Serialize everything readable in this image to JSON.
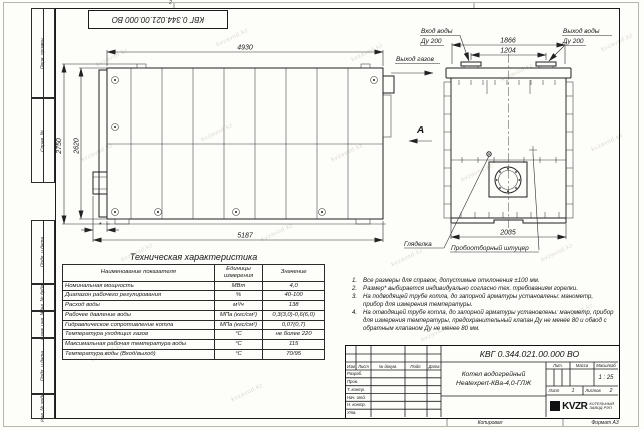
{
  "sheet": {
    "watermark": "kvzavod.kz",
    "top_mark": "2",
    "copied_label": "Копировал",
    "format_label": "Формат А3",
    "top_stamp": "КВГ 0.344.021.00.000 ВО"
  },
  "margin": {
    "labels": [
      "Перв. примен.",
      "Справ. №",
      "Подп. и дата",
      "Инв. № дубл.",
      "Взам. инв. №",
      "Подп. и дата",
      "Инв. № подл."
    ]
  },
  "drawing": {
    "main_view": {
      "dim_width_top": "4930",
      "dim_width_bottom": "5187",
      "dim_height_outer": "2750",
      "dim_height_inner": "2620",
      "dim_burner": "*"
    },
    "end_view": {
      "dim_nozzle_outer": "1866",
      "dim_nozzle_inner": "1204",
      "dim_width": "2035",
      "label_water_in": "Вход воды",
      "label_water_in_dn": "Ду 200",
      "label_water_out": "Выход воды",
      "label_water_out_dn": "Ду 200",
      "label_gas_out": "Выход газов",
      "view_arrow": "А",
      "label_sight_glass": "Гляделка",
      "label_sampling": "Пробоотборный штуцер"
    }
  },
  "spec_table": {
    "title": "Техническая характеристика",
    "headers": [
      "Наименование показателя",
      "Единицы измерения",
      "Значение"
    ],
    "rows": [
      [
        "Номинальная мощность",
        "МВт",
        "4,0"
      ],
      [
        "Диапазон рабочего регулирования",
        "%",
        "40-100"
      ],
      [
        "Расход воды",
        "м³/ч",
        "138"
      ],
      [
        "Рабочее давление воды",
        "МПа (кгс/см²)",
        "0,3(3,0)-0,6(6,0)"
      ],
      [
        "Гидравлическое сопротивление котла",
        "МПа (кгс/см²)",
        "0,07(0,7)"
      ],
      [
        "Температура уходящих газов",
        "°С",
        "не более 220"
      ],
      [
        "Максимальная рабочая температура воды",
        "°С",
        "115"
      ],
      [
        "Температура воды (Вход/выход)",
        "°С",
        "70/95"
      ]
    ]
  },
  "notes": {
    "items": [
      {
        "n": "1.",
        "text": "Все размеры для справок, допустимые отклонения ±100 мм."
      },
      {
        "n": "2.",
        "text": "Размер* выбирается индивидуально согласно тех. требованиям горелки."
      },
      {
        "n": "3.",
        "text": "На подводящей трубе котла, до запорной арматуры установлены: манометр, прибор для измерения температуры."
      },
      {
        "n": "4.",
        "text": "На отводящей трубе котла, до запорной арматуры установлены: манометр, прибор для измерения температуры, предохранительный клапан Ду не менее 80 и обвод с обратным клапаном Ду не менее 80 мм."
      }
    ]
  },
  "title_block": {
    "doc_number": "КВГ 0.344.021.00.000 ВО",
    "product_line1": "Котел водогрейный",
    "product_line2": "Heatexpert-КВа-4,0-ГЛЖ",
    "header_cols": [
      "Изм",
      "Лист",
      "№ докум.",
      "Подп.",
      "Дата"
    ],
    "row_labels": [
      "Разраб.",
      "Пров.",
      "Т. контр.",
      "Нач. отд.",
      "Н. контр.",
      "Утв."
    ],
    "lit_label": "Лит.",
    "mass_label": "Масса",
    "scale_label": "Масштаб",
    "scale_value": "1 : 25",
    "sheet_label": "Лист",
    "sheet_value": "1",
    "sheets_label": "Листов",
    "sheets_value": "2",
    "logo_text": "KVZR",
    "logo_sub1": "КОТЕЛЬНЫЙ",
    "logo_sub2": "ЗАВОД РЭП"
  }
}
